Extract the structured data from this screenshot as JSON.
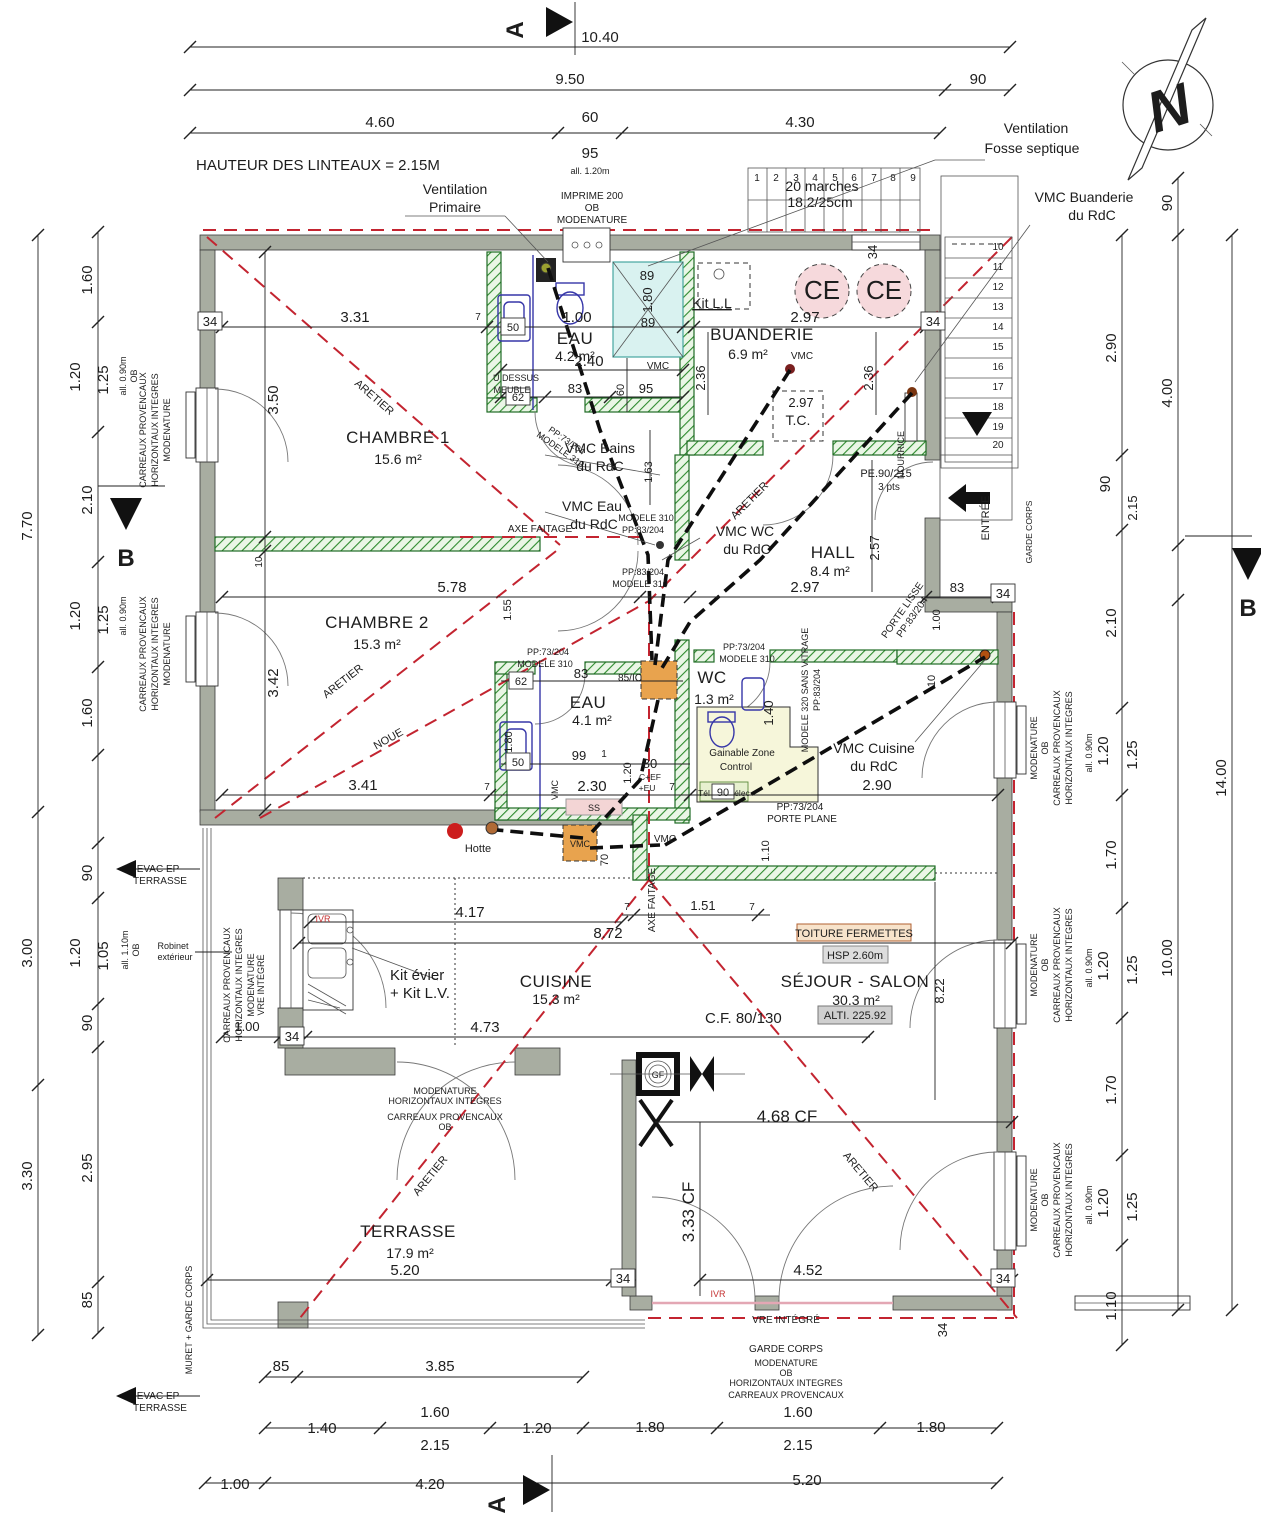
{
  "title": "Plan architecte - niveau avec chambres, buanderie, séjour et terrasse",
  "rooms": {
    "chambre1": {
      "name": "CHAMBRE 1",
      "area": "15.6 m²"
    },
    "chambre2": {
      "name": "CHAMBRE 2",
      "area": "15.3 m²"
    },
    "eau_haut": {
      "name": "EAU",
      "area": "4.2 m²"
    },
    "buanderie": {
      "name": "BUANDERIE",
      "area": "6.9 m²"
    },
    "hall": {
      "name": "HALL",
      "area": "8.4 m²"
    },
    "wc": {
      "name": "WC",
      "area": "1.3 m²"
    },
    "eau_bas": {
      "name": "EAU",
      "area": "4.1 m²"
    },
    "cuisine": {
      "name": "CUISINE",
      "area": "15.3 m²"
    },
    "sejour": {
      "name": "SÉJOUR - SALON",
      "area": "30.3 m²"
    },
    "terrasse": {
      "name": "TERRASSE",
      "area": "17.9 m²"
    },
    "tc": "T.C."
  },
  "stairs": {
    "top": [
      "1",
      "2",
      "3",
      "4",
      "5",
      "6",
      "7",
      "8",
      "9"
    ],
    "right": [
      "10",
      "11",
      "12",
      "13",
      "14",
      "15",
      "16",
      "17",
      "18",
      "19",
      "20"
    ],
    "note1": "20 marches",
    "note2": "18.2/25cm"
  },
  "t": {
    "a": "A",
    "b": "B",
    "n": "N",
    "note": "HAUTEUR DES LINTEAUX = 2.15M",
    "vent1": "Ventilation",
    "vent2": "Primaire",
    "imprime1": "IMPRIME 200",
    "imprime2": "OB",
    "imprime3": "MODENATURE",
    "fosse1": "Ventilation",
    "fosse2": "Fosse septique",
    "vmc_buand": "VMC Buanderie",
    "rdc": "du RdC",
    "vmc_bains": "VMC Bains",
    "vmc_eau": "VMC Eau",
    "vmc_wc": "VMC WC",
    "vmc_cuisine": "VMC Cuisine",
    "vmc": "VMC",
    "kit_ll": "Kit L.L",
    "kit_evier": "Kit évier",
    "kit_lv": "+ Kit L.V.",
    "hotte": "Hotte",
    "ce": "CE",
    "gf": "GF",
    "ss": "SS",
    "pe90": "PE.90/215",
    "pts3": "3 pts",
    "pp73": "PP:73/204",
    "pp83": "PP:83/204",
    "mod310": "MODELE 310",
    "mod320": "MODELE 320 SANS VITRAGE",
    "porte_lisse": "PORTE LISSE",
    "porte_plane": "PORTE PLANE",
    "dessus1": "U DESSUS",
    "dessus2": "MEUBLE",
    "gain1": "Gainable Zone",
    "gain2": "Control",
    "tel": "Tél",
    "elec": "élec",
    "nourrice": "NOURRICE",
    "entree": "ENTRÉE",
    "garde_corps": "GARDE CORPS",
    "axe_faitage": "AXE FAITAGE",
    "aretier": "ARETIER",
    "noue": "NOUE",
    "ivr": "IVR",
    "vre_integre": "VRE INTÉGRÉ",
    "modenature": "MODENATURE",
    "ob": "OB",
    "carreaux": "CARREAUX PROVENCAUX",
    "horizontaux": "HORIZONTAUX INTEGRES",
    "evac1": "EVAC EP",
    "evac2": "TERRASSE",
    "robinet1": "Robinet",
    "robinet2": "extérieur",
    "muret": "MURET + GARDE CORPS",
    "toiture": "TOITURE FERMETTES",
    "hsp": "HSP 2.60m",
    "alti": "ALTI. 225.92",
    "cf": "C.F. 80/130",
    "cf468": "4.68 CF",
    "cf333": "3.33 CF",
    "cef": "C+EF",
    "eu": "+EU"
  },
  "d": {
    "1": "1",
    "7": "7",
    "10": "10",
    "34": "34",
    "50": "50",
    "60": "60",
    "62": "62",
    "70": "70",
    "80": "80",
    "83": "83",
    "85": "85",
    "89": "89",
    "90": "90",
    "95": "95",
    "99": "99",
    "85ic": "85/IC",
    "1_00": "1.00",
    "1_05": "1.05",
    "1_10": "1.10",
    "1_20": "1.20",
    "1_25": "1.25",
    "1_40": "1.40",
    "1_51": "1.51",
    "1_55": "1.55",
    "1_60": "1.60",
    "1_63": "1.63",
    "1_70": "1.70",
    "1_80": "1.80",
    "2_10": "2.10",
    "2_15": "2.15",
    "2_30": "2.30",
    "2_36": "2.36",
    "2_40": "2.40",
    "2_57": "2.57",
    "2_90": "2.90",
    "2_95": "2.95",
    "2_97": "2.97",
    "3_00": "3.00",
    "3_30": "3.30",
    "3_31": "3.31",
    "3_41": "3.41",
    "3_42": "3.42",
    "3_50": "3.50",
    "3_85": "3.85",
    "4_00": "4.00",
    "4_17": "4.17",
    "4_20": "4.20",
    "4_30": "4.30",
    "4_52": "4.52",
    "4_60": "4.60",
    "4_73": "4.73",
    "5_20": "5.20",
    "5_78": "5.78",
    "7_70": "7.70",
    "8_22": "8.22",
    "8_72": "8.72",
    "9_50": "9.50",
    "10_00": "10.00",
    "10_40": "10.40",
    "14_00": "14.00",
    "all090": "all. 0.90m",
    "all110": "all. 1.10m",
    "all120": "all. 1.20m"
  },
  "colors": {
    "wall": "#a8ada1",
    "partition_hatch": "#2e8b2e",
    "roof_line": "#c32430",
    "shower": "#d9f2f0",
    "ce_fill": "#f6d9dc",
    "tech_zone": "#f6f6da",
    "vmc_box": "#e8a34e",
    "toiture_bg": "#f7e3cb",
    "alti_bg": "#cfcfcf"
  }
}
